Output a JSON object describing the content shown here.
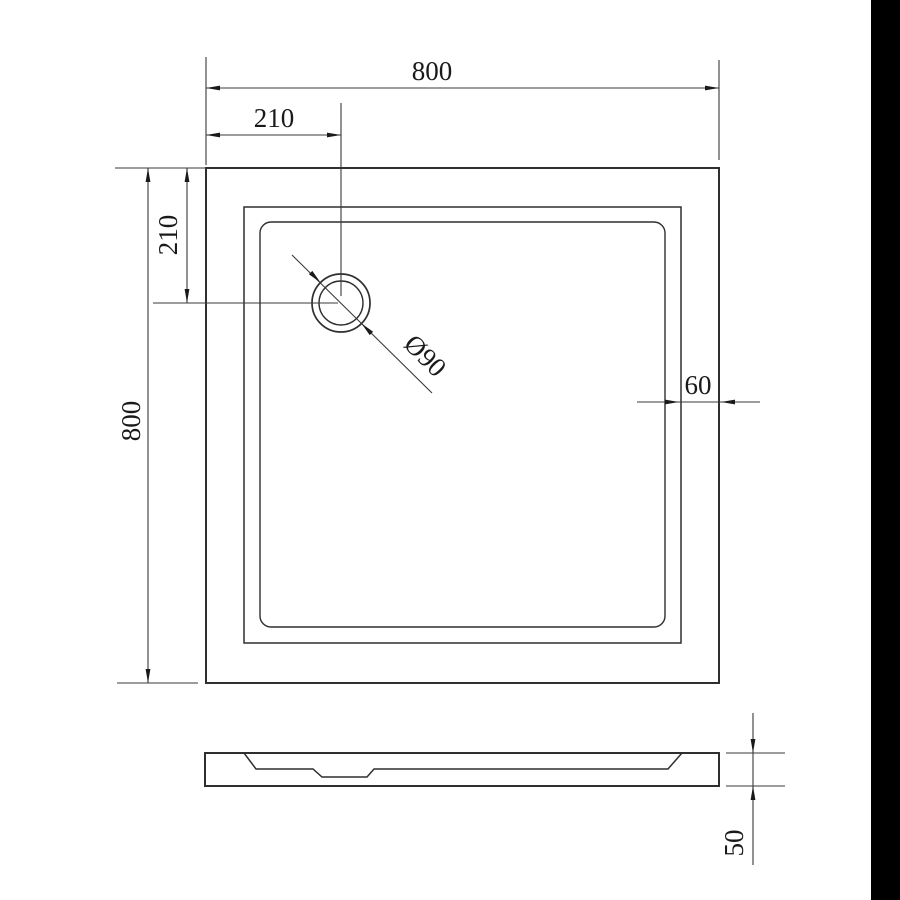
{
  "page": {
    "background": "#ffffff",
    "line_color": "#2f2f2f",
    "text_color": "#1a1a1a",
    "right_band_color": "#000000"
  },
  "top_view": {
    "dim_overall_width": "800",
    "dim_drain_offset_x": "210",
    "dim_drain_offset_y": "210",
    "dim_overall_depth": "800",
    "dim_rim_width": "60",
    "dim_drain_diameter": "Ø90"
  },
  "side_view": {
    "dim_height": "50"
  }
}
